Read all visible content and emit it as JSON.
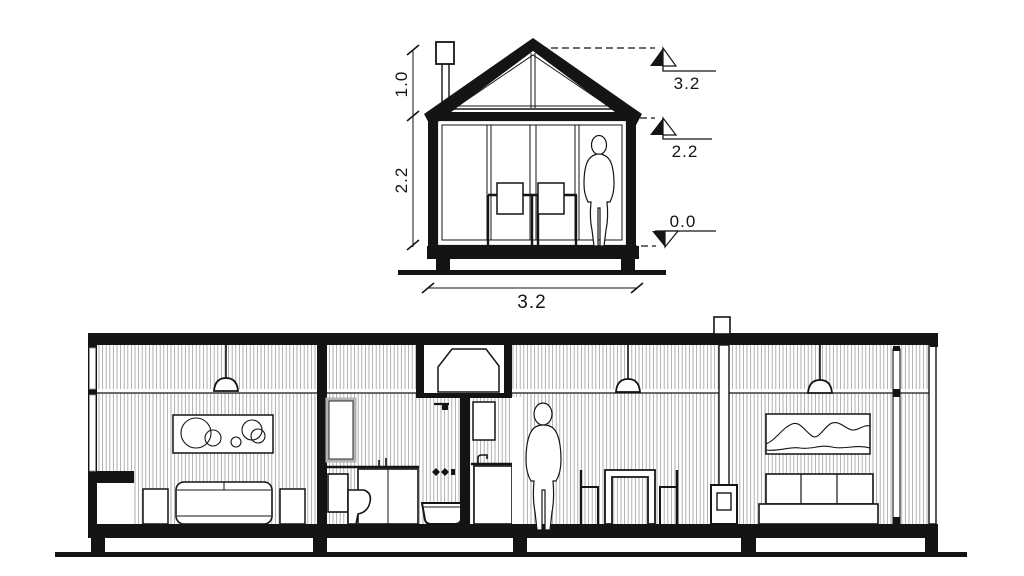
{
  "drawing": {
    "title_hint": "house sections",
    "colors": {
      "ink": "#141414",
      "stripe": "#8f8f8f",
      "frame_gray": "#b3b3b3",
      "background": "#ffffff"
    }
  },
  "cross_section": {
    "dim_roof_height": "1.0",
    "dim_wall_height": "2.2",
    "dim_width": "3.2",
    "levels": {
      "ridge": "3.2",
      "eave": "2.2",
      "floor": "0.0"
    }
  }
}
